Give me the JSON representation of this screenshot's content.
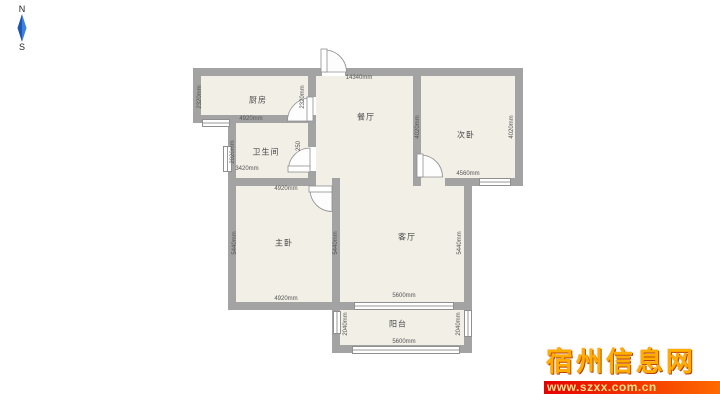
{
  "compass": {
    "north": "N",
    "south": "S"
  },
  "rooms": {
    "kitchen": {
      "label": "厨房"
    },
    "bathroom": {
      "label": "卫生间"
    },
    "dining": {
      "label": "餐厅"
    },
    "bedroom2": {
      "label": "次卧"
    },
    "master": {
      "label": "主卧"
    },
    "living": {
      "label": "客厅"
    },
    "balcony": {
      "label": "阳台"
    }
  },
  "dimensions": {
    "total_top": "14340mm",
    "kitchen_left": "2320mm",
    "kitchen_right": "2320mm",
    "kitchen_bottom": "4920mm",
    "bath_left": "2020mm",
    "bath_right": "250",
    "bath_bottom": "3420mm",
    "dining_bedroom2_wall": "4020mm",
    "bedroom2_right": "4020mm",
    "bedroom2_bottom": "4560mm",
    "master_top": "4920mm",
    "master_left": "5440mm",
    "master_right": "5440mm",
    "master_bottom": "4920mm",
    "living_right": "5440mm",
    "living_bottom": "5600mm",
    "balcony_left": "2040mm",
    "balcony_right": "2040mm",
    "balcony_bottom": "5600mm"
  },
  "watermark": {
    "site_name": "宿州信息网",
    "url": "www.szxx.com.cn"
  },
  "colors": {
    "wall": "#a3a3a3",
    "floor": "#f1efe6",
    "win_border": "#8f8f8f",
    "compass_arrow": "#2e74d8",
    "wm_gold": "#ffae00",
    "wm_band": "#e60000"
  }
}
